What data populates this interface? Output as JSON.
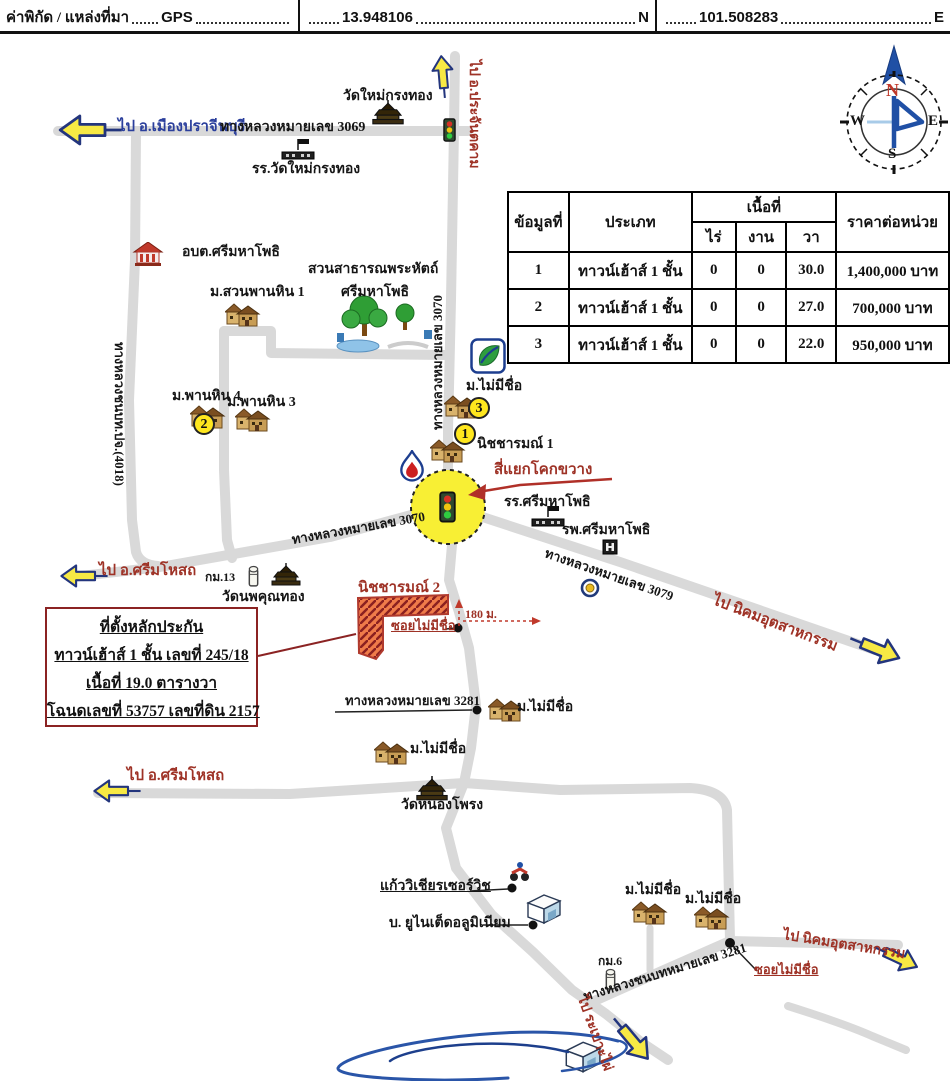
{
  "header": {
    "label": "ค่าพิกัด / แหล่งที่มา",
    "source": "GPS",
    "latitude": "13.948106",
    "latitude_suffix": "N",
    "longitude": "101.508283",
    "longitude_suffix": "E"
  },
  "table": {
    "headers": {
      "no": "ข้อมูลที่",
      "type": "ประเภท",
      "area_group": "เนื้อที่",
      "rai": "ไร่",
      "ngan": "งาน",
      "wa": "วา",
      "unit_price": "ราคาต่อหน่วย"
    },
    "rows": [
      {
        "no": "1",
        "type": "ทาวน์เฮ้าส์ 1 ชั้น",
        "rai": "0",
        "ngan": "0",
        "wa": "30.0",
        "price": "1,400,000 บาท"
      },
      {
        "no": "2",
        "type": "ทาวน์เฮ้าส์ 1 ชั้น",
        "rai": "0",
        "ngan": "0",
        "wa": "27.0",
        "price": "700,000 บาท"
      },
      {
        "no": "3",
        "type": "ทาวน์เฮ้าส์ 1 ชั้น",
        "rai": "0",
        "ngan": "0",
        "wa": "22.0",
        "price": "950,000 บาท"
      }
    ]
  },
  "compass": {
    "north": "N",
    "south": "S",
    "east": "E",
    "west": "W"
  },
  "info_box": {
    "title": "ที่ตั้งหลักประกัน",
    "line2": "ทาวน์เฮ้าส์  1 ชั้น เลขที่ 245/18",
    "line3": "เนื้อที่ 19.0 ตารางวา",
    "line4": "โฉนดเลขที่ 53757 เลขที่ดิน 2157"
  },
  "badges": {
    "no1": "1",
    "no2": "2",
    "no3": "3"
  },
  "labels": {
    "to_prachantakham": "ไป อ.ประจันตคาม",
    "to_mueang_prachinburi": "ไป อ.เมืองปราจีนบุรี",
    "road_3069": "ทางหลวงหมายเลข 3069",
    "wat_mai_krongthong": "วัดใหม่กรงทอง",
    "school_wat_mai_krongthong": "รร.วัดใหม่กรงทอง",
    "obt_srimahaphot": "อบต.ศรีมหาโพธิ",
    "park_line1": "สวนสาธารณพระหัตถ์",
    "park_line2": "ศรีมหาโพธิ",
    "m_suan_phan_hin_1": "ม.สวนพานหิน 1",
    "m_phan_hin_4": "ม.พานหิน 4",
    "m_phan_hin_3": "ม.พานหิน 3",
    "rural_road_4018": "ทางหลวงชนบท.ปจ.(4018)",
    "road_3070_vertical": "ทางหลวงหมายเลข 3070",
    "m_no_name_ptt": "ม.ไม่มีชื่อ",
    "nitcharom_1": "นิชชารมณ์ 1",
    "kok_khwang_intersection": "สี่แยกโคกขวาง",
    "school_srimahaphot": "รร.ศรีมหาโพธิ",
    "hospital_srimahaphot": "รพ.ศรีมหาโพธิ",
    "road_3079": "ทางหลวงหมายเลข 3079",
    "to_nikhom_1": "ไป นิคมอุตสาหกรรม",
    "road_3070_diagonal": "ทางหลวงหมายเลข 3070",
    "to_srimahosot_1": "ไป อ.ศรีมโหสถ",
    "km_13": "กม.13",
    "wat_nopphakhun_thong": "วัดนพคุณทอง",
    "nitcharom_2": "นิชชารมณ์ 2",
    "soi_no_name_1": "ซอยไม่มีชื่อ",
    "distance_180m": "180 ม.",
    "road_3281": "ทางหลวงหมายเลข 3281",
    "m_no_name_3281": "ม.ไม่มีชื่อ",
    "m_no_name_mid": "ม.ไม่มีชื่อ",
    "wat_nong_phrong": "วัดหนองโพรง",
    "to_srimahosot_2": "ไป อ.ศรีมโหสถ",
    "kaew_wichian_service": "แก้ววิเชียรเซอร์วิช",
    "united_aluminium": "บ. ยูไนเต็ดอลูมิเนียม",
    "m_no_name_b1": "ม.ไม่มีชื่อ",
    "m_no_name_b2": "ม.ไม่มีชื่อ",
    "to_nikhom_2": "ไป นิคมอุตสาหกรรม",
    "km_6": "กม.6",
    "rural_road_3281": "ทางหลวงชนบทหมายเลข 3281",
    "soi_no_name_2": "ซอยไม่มีชื่อ",
    "to_rabo_phai": "ไป ระเบาะไผ่"
  },
  "colors": {
    "road_gray": "#d9d9d9",
    "direction_red": "#9e3226",
    "direction_blue": "#2b3f9c",
    "arrow_yellow": "#f7e944",
    "arrow_outline": "#23357d",
    "intersection_yellow": "#f8ef34",
    "parcel_fill": "#ef7b4a",
    "parcel_border": "#b03a2e",
    "info_box_border": "#8b2323"
  }
}
